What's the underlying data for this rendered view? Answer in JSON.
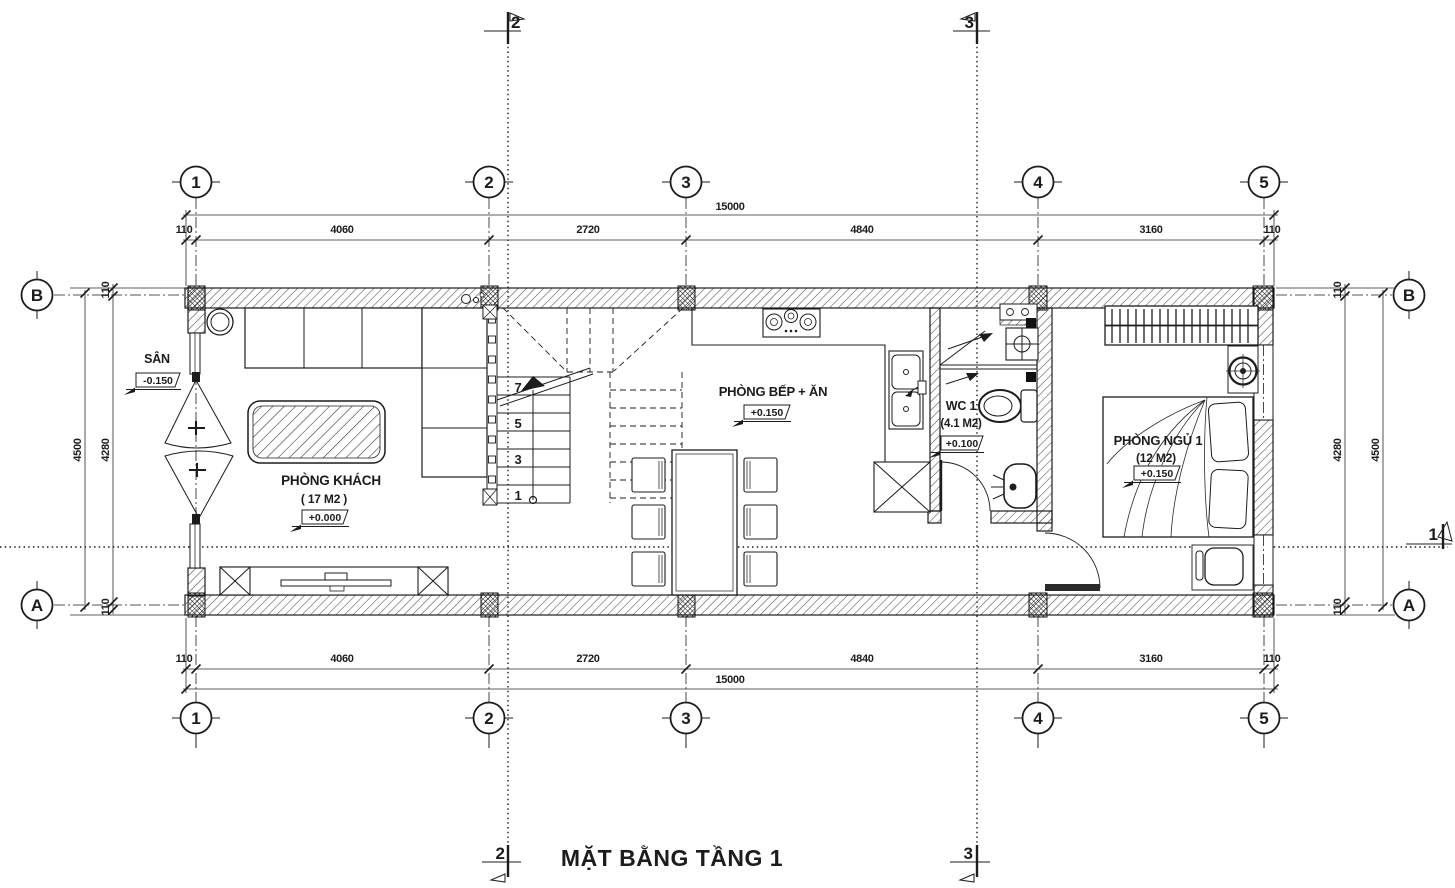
{
  "title": "MẶT BẰNG TẦNG 1",
  "colors": {
    "line": "#1c1c1c",
    "paper": "#ffffff",
    "hatch": "#4f4f4f"
  },
  "grid": {
    "cols": [
      "1",
      "2",
      "3",
      "4",
      "5"
    ],
    "row_a": "A",
    "row_b": "B"
  },
  "sections": {
    "one": "1",
    "two": "2",
    "three": "3"
  },
  "dims": {
    "overall": "15000",
    "top": [
      "110",
      "4060",
      "2720",
      "4840",
      "3160",
      "110"
    ],
    "bottom": [
      "110",
      "4060",
      "2720",
      "4840",
      "3160",
      "110"
    ],
    "left": {
      "off_top": "110",
      "inner": "4280",
      "outer": "4500",
      "off_bottom": "110"
    },
    "right": {
      "off_top": "110",
      "inner": "4280",
      "outer": "4500",
      "off_bottom": "110"
    }
  },
  "rooms": {
    "san": {
      "name": "SÂN",
      "level": "-0.150"
    },
    "khach": {
      "name": "PHÒNG KHÁCH",
      "area": "( 17 M2 )",
      "level": "+0.000"
    },
    "bep": {
      "name": "PHÒNG BẾP + ĂN",
      "level": "+0.150"
    },
    "wc": {
      "name": "WC 1",
      "area": "(4.1 M2)",
      "level": "+0.100"
    },
    "ngu": {
      "name": "PHÒNG NGỦ 1",
      "area": "(12 M2)",
      "level": "+0.150"
    }
  },
  "stairs": {
    "steps": [
      "7",
      "5",
      "3",
      "1"
    ]
  }
}
